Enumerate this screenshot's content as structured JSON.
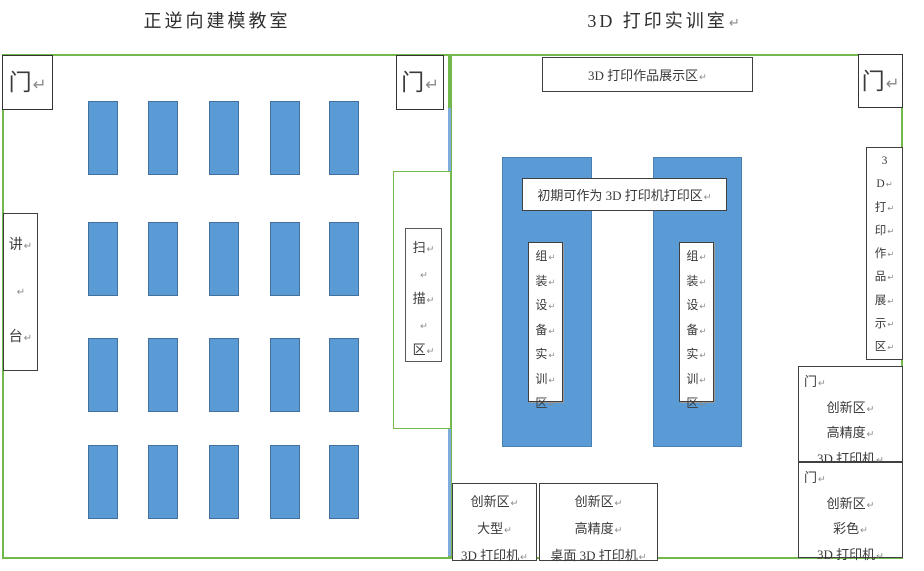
{
  "colors": {
    "room_border": "#72b84d",
    "divider_blue": "#7eabdc",
    "desk_fill": "#5b9bd5",
    "desk_border": "#41719c",
    "box_border": "#404040",
    "text": "#3a3a3a",
    "linebreak_mark": "#8a8a8a"
  },
  "left_room": {
    "title": "正逆向建模教室",
    "door_top_left": [
      "门↵"
    ],
    "door_top_right": [
      "门↵"
    ],
    "podium": {
      "lines": [
        "讲↵",
        "↵",
        "台↵"
      ]
    },
    "scan_area": {
      "lines": [
        "扫↵",
        "↵",
        "描↵",
        "↵",
        "区↵"
      ]
    },
    "desks": {
      "rows": 4,
      "cols": 5
    }
  },
  "right_room": {
    "title": [
      "3D 打印实训室↵"
    ],
    "door_top_right": [
      "门↵"
    ],
    "display_top": [
      "3D 打印作品展示区↵"
    ],
    "print_zone_label": [
      "初期可作为 3D 打印机打印区↵"
    ],
    "assembly_left": {
      "lines": [
        "组↵",
        "装↵",
        "设↵",
        "备↵",
        "实↵",
        "训↵",
        "区↵"
      ]
    },
    "assembly_right": {
      "lines": [
        "组↵",
        "装↵",
        "设↵",
        "备↵",
        "实↵",
        "训↵",
        "区↵"
      ]
    },
    "display_right": {
      "lines": [
        "3",
        "D↵",
        "打↵",
        "印↵",
        "作↵",
        "品↵",
        "展↵",
        "示↵",
        "区↵"
      ]
    },
    "innovation_large": {
      "lines": [
        "创新区↵",
        "大型↵",
        "3D 打印机↵"
      ]
    },
    "innovation_desktop": {
      "lines": [
        "创新区↵",
        "高精度↵",
        "桌面 3D 打印机↵"
      ]
    },
    "innovation_high_precision": {
      "lines": [
        "门↵",
        "创新区↵",
        "高精度↵",
        "3D 打印机↵"
      ]
    },
    "innovation_color": {
      "lines": [
        "门↵",
        "创新区↵",
        "彩色↵",
        "3D 打印机↵"
      ]
    }
  }
}
